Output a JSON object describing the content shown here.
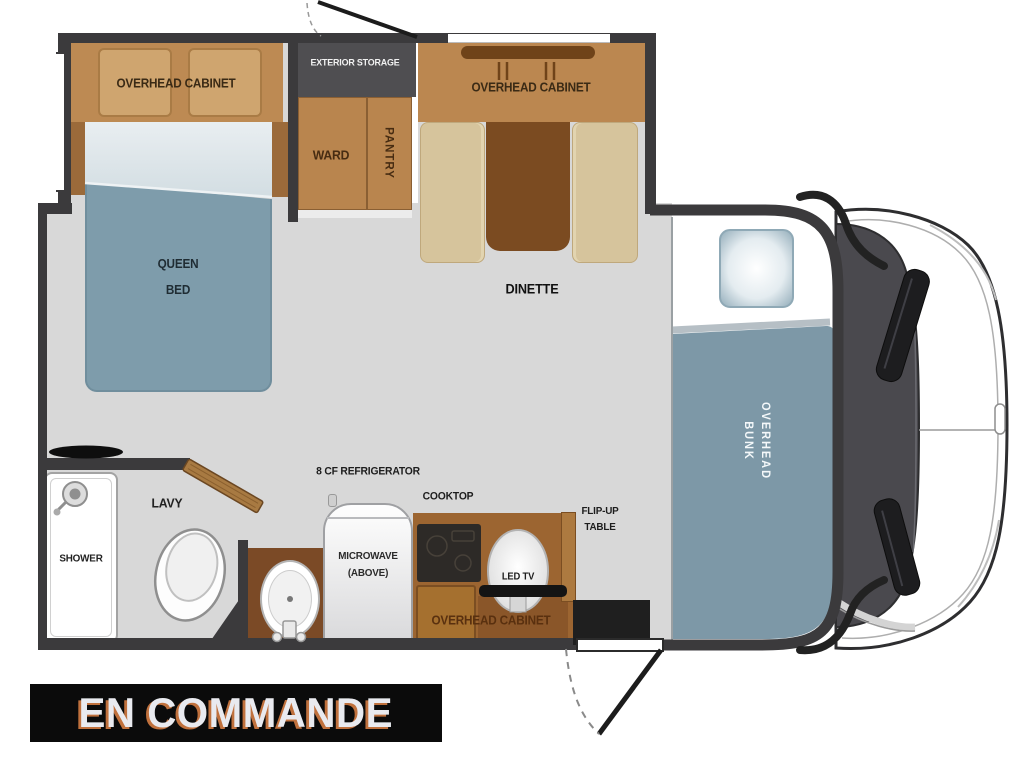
{
  "floorplan": {
    "bedroom": {
      "overhead_cabinet_label": "OVERHEAD CABINET",
      "bed_label_line1": "QUEEN",
      "bed_label_line2": "BED"
    },
    "storage": {
      "exterior_storage_label": "EXTERIOR STORAGE",
      "wardrobe_label": "WARD",
      "pantry_label": "PANTRY"
    },
    "dinette": {
      "overhead_cabinet_label": "OVERHEAD CABINET",
      "label": "DINETTE"
    },
    "bunk": {
      "label_line1": "OVERHEAD",
      "label_line2": "BUNK"
    },
    "bathroom": {
      "shower_label": "SHOWER",
      "lavatory_label": "LAVY"
    },
    "kitchen": {
      "refrigerator_label": "8 CF REFRIGERATOR",
      "microwave_label_line1": "MICROWAVE",
      "microwave_label_line2": "(ABOVE)",
      "cooktop_label": "COOKTOP",
      "led_tv_label": "LED TV",
      "overhead_cabinet_label": "OVERHEAD CABINET",
      "flip_up_table_label_line1": "FLIP-UP",
      "flip_up_table_label_line2": "TABLE"
    }
  },
  "banner": {
    "text": "EN COMMANDE"
  },
  "colors": {
    "wall": "#3b3a3c",
    "floor": "#d8d8d8",
    "cabinet_tan": "#bd8a53",
    "cabinet_panel": "#cfa56f",
    "bench_beige": "#d6c49c",
    "table_brown": "#7b4b21",
    "counter_brown": "#9c6531",
    "bed_blue": "#7e9cab",
    "bunk_blue": "#7d98a7",
    "exterior_storage_gray": "#4f4e51",
    "banner_bg": "#0b0b0b",
    "banner_text": "#e9eaef",
    "banner_shadow": "#c0713d"
  }
}
